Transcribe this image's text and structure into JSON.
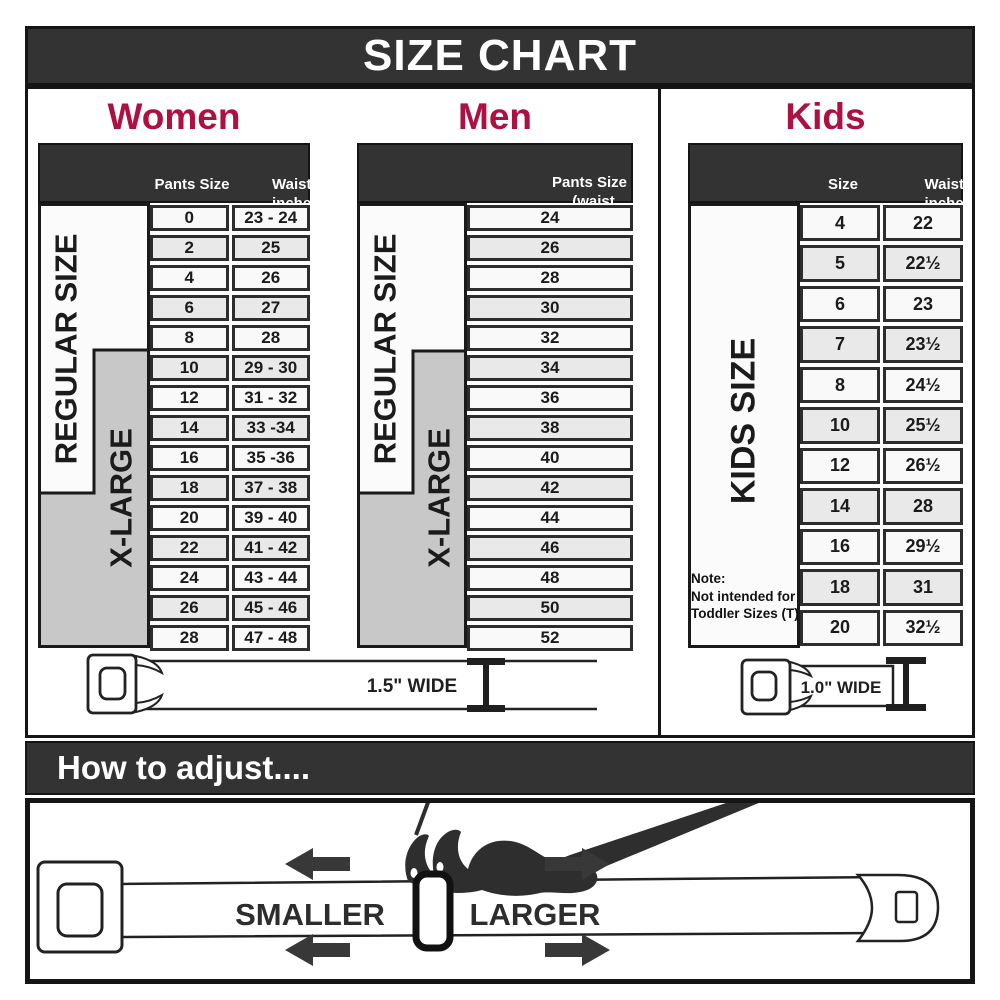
{
  "title": "SIZE CHART",
  "colors": {
    "accent": "#ad1043",
    "header_dark": "#333333"
  },
  "sections": {
    "women": {
      "heading": "Women",
      "columns": {
        "col1": "Pants Size",
        "col2_line1": "Waist",
        "col2_line2": "inches"
      },
      "labels": {
        "regular": "REGULAR SIZE",
        "xlarge": "X-LARGE"
      },
      "rows": [
        {
          "size": "0",
          "waist": "23 - 24"
        },
        {
          "size": "2",
          "waist": "25"
        },
        {
          "size": "4",
          "waist": "26"
        },
        {
          "size": "6",
          "waist": "27"
        },
        {
          "size": "8",
          "waist": "28"
        },
        {
          "size": "10",
          "waist": "29 - 30"
        },
        {
          "size": "12",
          "waist": "31 - 32"
        },
        {
          "size": "14",
          "waist": "33 -34"
        },
        {
          "size": "16",
          "waist": "35 -36"
        },
        {
          "size": "18",
          "waist": "37 - 38"
        },
        {
          "size": "20",
          "waist": "39 - 40"
        },
        {
          "size": "22",
          "waist": "41 - 42"
        },
        {
          "size": "24",
          "waist": "43 - 44"
        },
        {
          "size": "26",
          "waist": "45 - 46"
        },
        {
          "size": "28",
          "waist": "47 - 48"
        }
      ]
    },
    "men": {
      "heading": "Men",
      "columns": {
        "col1_line1": "Pants Size",
        "col1_line2": "(waist inches)"
      },
      "labels": {
        "regular": "REGULAR SIZE",
        "xlarge": "X-LARGE"
      },
      "rows": [
        "24",
        "26",
        "28",
        "30",
        "32",
        "34",
        "36",
        "38",
        "40",
        "42",
        "44",
        "46",
        "48",
        "50",
        "52"
      ]
    },
    "kids": {
      "heading": "Kids",
      "columns": {
        "col1": "Size",
        "col2_line1": "Waist",
        "col2_line2": "inches"
      },
      "labels": {
        "kids": "KIDS SIZE"
      },
      "note": [
        "Note:",
        "Not intended for",
        "Toddler Sizes (T)"
      ],
      "rows": [
        {
          "size": "4",
          "waist": "22"
        },
        {
          "size": "5",
          "waist": "22½"
        },
        {
          "size": "6",
          "waist": "23"
        },
        {
          "size": "7",
          "waist": "23½"
        },
        {
          "size": "8",
          "waist": "24½"
        },
        {
          "size": "10",
          "waist": "25½"
        },
        {
          "size": "12",
          "waist": "26½"
        },
        {
          "size": "14",
          "waist": "28"
        },
        {
          "size": "16",
          "waist": "29½"
        },
        {
          "size": "18",
          "waist": "31"
        },
        {
          "size": "20",
          "waist": "32½"
        }
      ]
    }
  },
  "belts": {
    "adult_width_label": "1.5\" WIDE",
    "kids_width_label": "1.0\" WIDE"
  },
  "adjust": {
    "heading": "How to adjust....",
    "smaller": "SMALLER",
    "larger": "LARGER"
  }
}
